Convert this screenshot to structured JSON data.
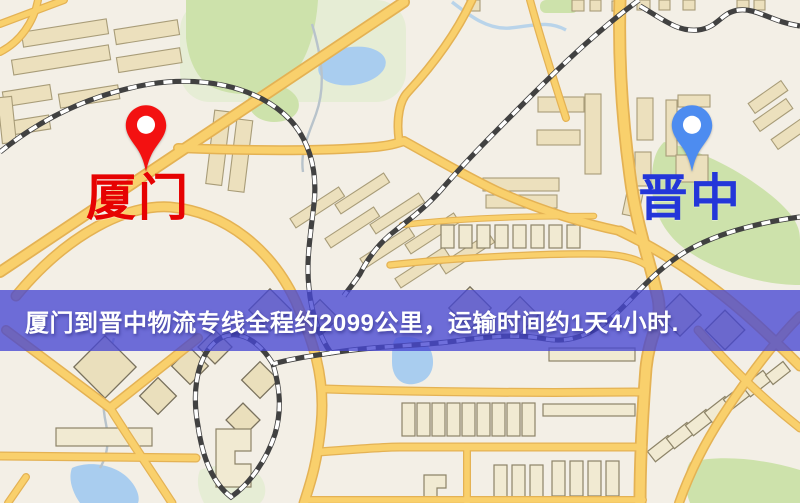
{
  "palette": {
    "map-bg": "#f3efe6",
    "road-fill": "#f9d06c",
    "road-border": "#e4b254",
    "water": "#a9cdef",
    "park": "#cde2ab",
    "park-pale": "#e6edd5",
    "building-fill": "#ece0bd",
    "building-stroke": "#a89c78",
    "rail-dark": "#414141"
  },
  "banner": {
    "text": "厦门到晋中物流专线全程约2099公里，运输时间约1天4小时.",
    "background": "#4646d2",
    "text_color": "#ffffff",
    "distance_km": "2099",
    "duration": "1天4小时"
  },
  "markers": {
    "origin": {
      "label": "厦门",
      "pin_color": "#f31111",
      "label_color": "#e60202"
    },
    "destination": {
      "label": "晋中",
      "pin_color": "#4d8cf0",
      "label_color": "#2336d9"
    }
  }
}
